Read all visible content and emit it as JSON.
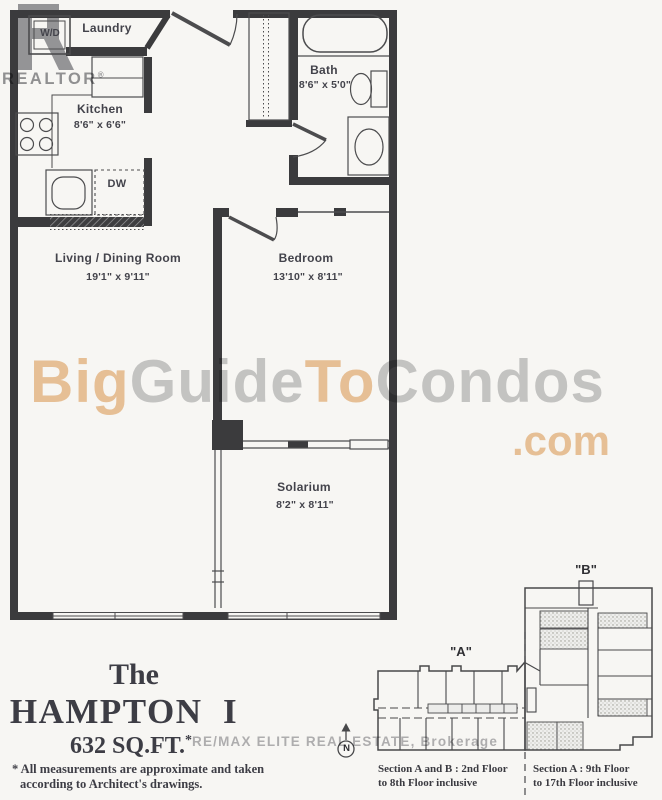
{
  "watermarks": {
    "realtor_logo_letter": "R",
    "realtor_text": "REALTOR",
    "registered_symbol": "®",
    "big_guide_segments": [
      {
        "text": "Big",
        "color": "#e0984a"
      },
      {
        "text": "Guide",
        "color": "#9a9aa0"
      },
      {
        "text": "To",
        "color": "#e0984a"
      },
      {
        "text": "Condos",
        "color": "#9a9aa0"
      }
    ],
    "dot_com": ".com",
    "dot_com_color": "#e0984a",
    "brokerage_text": "RE/MAX ELITE REAL ESTATE, Brokerage"
  },
  "floor_plan": {
    "rooms": {
      "laundry": {
        "name": "Laundry"
      },
      "kitchen": {
        "name": "Kitchen",
        "dims": "8'6\" x 6'6\""
      },
      "bath": {
        "name": "Bath",
        "dims": "8'6\" x 5'0\""
      },
      "living_dining": {
        "name": "Living / Dining Room",
        "dims": "19'1\" x 9'11\""
      },
      "bedroom": {
        "name": "Bedroom",
        "dims": "13'10\" x 8'11\""
      },
      "solarium": {
        "name": "Solarium",
        "dims": "8'2\" x 8'11\""
      }
    },
    "appliances": {
      "washer_dryer": "W/D",
      "dishwasher": "DW"
    }
  },
  "title_block": {
    "prefix": "The",
    "name": "HAMPTON  I",
    "area": "632 SQ.FT.",
    "area_asterisk": "*",
    "note_line1": "* All measurements are approximate and taken",
    "note_line2": "according to Architect's drawings."
  },
  "key_plan": {
    "section_a_label": "\"A\"",
    "section_b_label": "\"B\"",
    "north_label": "N",
    "caption_left": {
      "line1": "Section A and B : 2nd Floor",
      "line2": "to 8th Floor inclusive"
    },
    "caption_right": {
      "line1": "Section A : 9th Floor",
      "line2": "to 17th Floor inclusive"
    }
  }
}
